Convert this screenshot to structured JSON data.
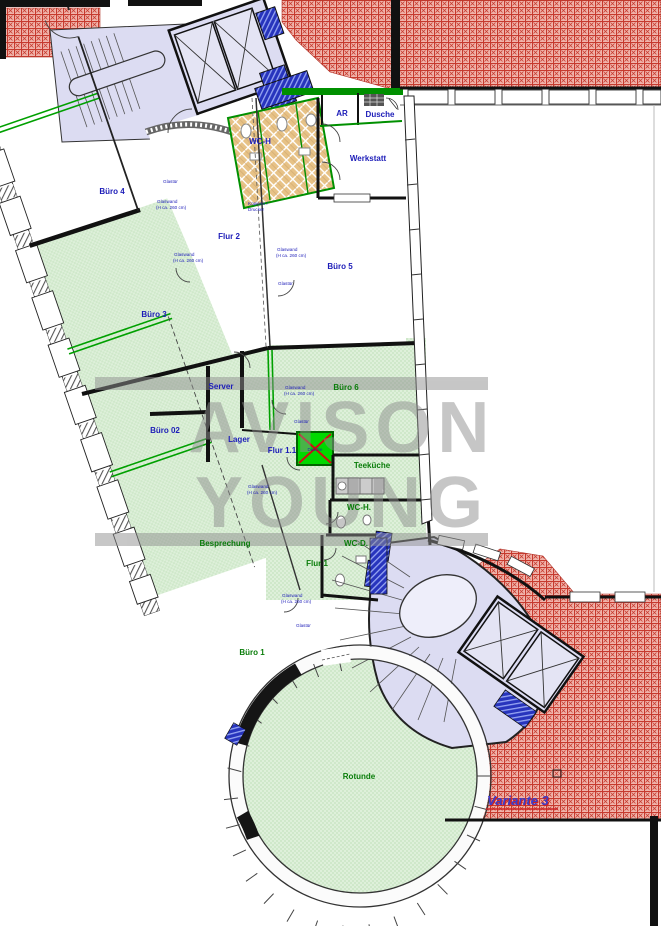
{
  "drawing": {
    "variant_label": "Variante 3",
    "watermark": {
      "line1": "AVISON",
      "line2": "YOUNG"
    },
    "rooms": {
      "buero4": "Büro 4",
      "flur2": "Flur 2",
      "buero3": "Büro 3",
      "buero5": "Büro 5",
      "werkstatt": "Werkstatt",
      "wc_h_top": "WC-H",
      "ar": "AR",
      "dusche": "Dusche",
      "server": "Server",
      "buero6": "Büro 6",
      "buero02": "Büro 02",
      "lager": "Lager",
      "flur11": "Flur 1.1",
      "teekueche": "Teeküche",
      "wc_h": "WC-H.",
      "wc_d": "WC-D.",
      "besprechung": "Besprechung",
      "flur1": "Flur 1",
      "buero1": "Büro 1",
      "rotunde": "Rotunde"
    },
    "annotations": {
      "glaswand_line1": "Glaswand",
      "glaswand_line2": "(H ca. 260 cm)",
      "glastuer": "Glastür",
      "kopierer_line1": "Kopierer /",
      "kopierer_line2": "Drucker",
      "dusche_mark": "Dusche"
    },
    "colors": {
      "label_blue": "#1c1cb8",
      "label_green": "#0a7d0a",
      "new_wall_green": "#00a000",
      "roof_red": "#c63a2e",
      "shaft_blue": "#2734bd",
      "stair_lavender": "#dcdcf2",
      "room_green": "#def0da",
      "tile_tan": "#e7c286",
      "variant_blue": "#3c3cc8"
    }
  }
}
